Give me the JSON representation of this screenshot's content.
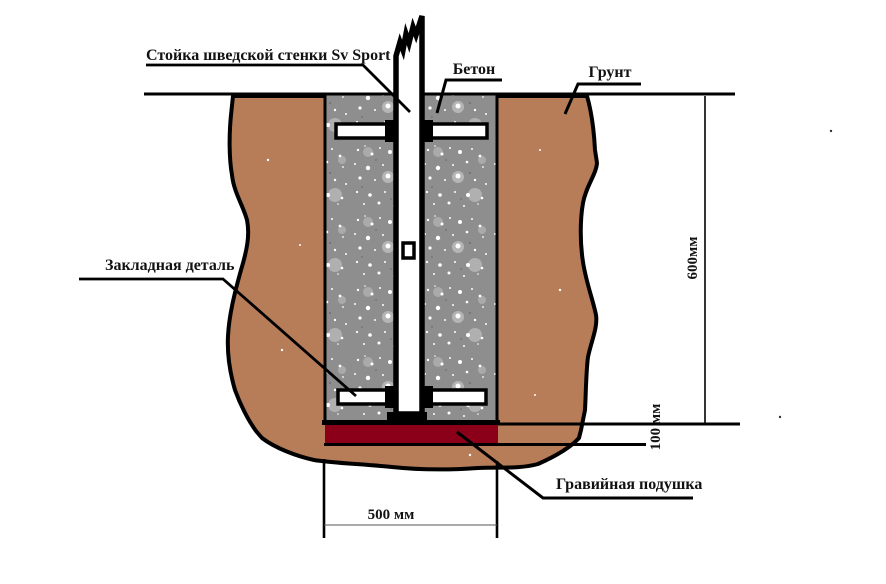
{
  "labels": {
    "post": "Стойка шведской стенки Sv Sport",
    "concrete": "Бетон",
    "soil": "Грунт",
    "embedded_part": "Закладная деталь",
    "gravel_pad": "Гравийная подушка"
  },
  "dimensions": {
    "depth": "600мм",
    "pad_thickness": "100 мм",
    "pit_width": "500 мм"
  },
  "colors": {
    "soil": "#b77c58",
    "concrete": "#8e8e8e",
    "gravel_pad": "#8b0018",
    "outline": "#000000",
    "background": "#ffffff"
  }
}
